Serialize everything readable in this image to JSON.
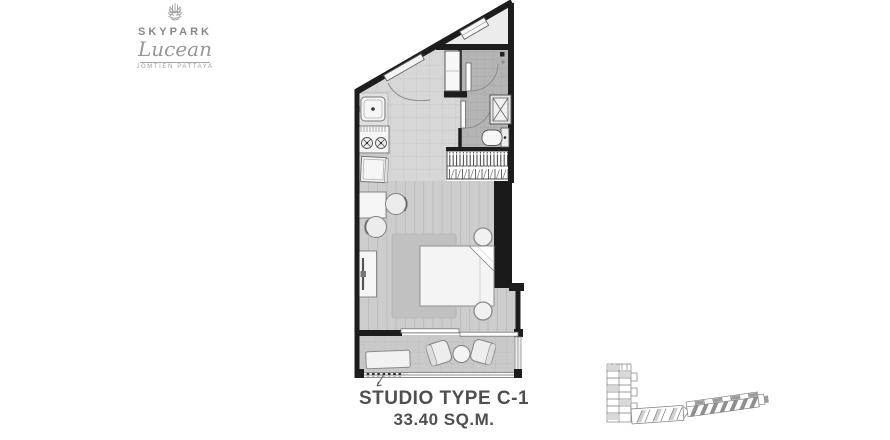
{
  "logo": {
    "brand": "SKYPARK",
    "name": "Lucean",
    "location": "JOMTIEN PATTAYA"
  },
  "unit": {
    "title": "STUDIO TYPE C-1",
    "area": "33.40 SQ.M."
  },
  "floor_plan": {
    "features": [
      "entrance-door",
      "open-triangle-terrace",
      "window",
      "entry-closet",
      "bathroom-door",
      "shower",
      "toilet",
      "kitchen-counter",
      "kitchen-sink",
      "stove",
      "refrigerator",
      "dining-table",
      "dining-chairs",
      "tv-console",
      "wardrobe",
      "service-shaft",
      "bed",
      "bedside-stools",
      "rug",
      "sliding-door",
      "balcony",
      "balcony-bench",
      "lounge-chairs",
      "balcony-table",
      "balcony-railing",
      "ac-ledge"
    ]
  },
  "key_plan": {
    "buildings": [
      "l-shaped-wing",
      "bar-wing-with-highlighted-units"
    ],
    "highlight_color": "#8f8f8f"
  },
  "colors": {
    "wall": "#1d1d1d",
    "floor_living": "#cdcdcd",
    "floor_kitchen": "#d7d7d7",
    "floor_bathroom": "#b4b4b4",
    "floor_balcony": "#c9c9c9",
    "title_text": "#4e4f51",
    "logo_gray": "#94989b"
  }
}
